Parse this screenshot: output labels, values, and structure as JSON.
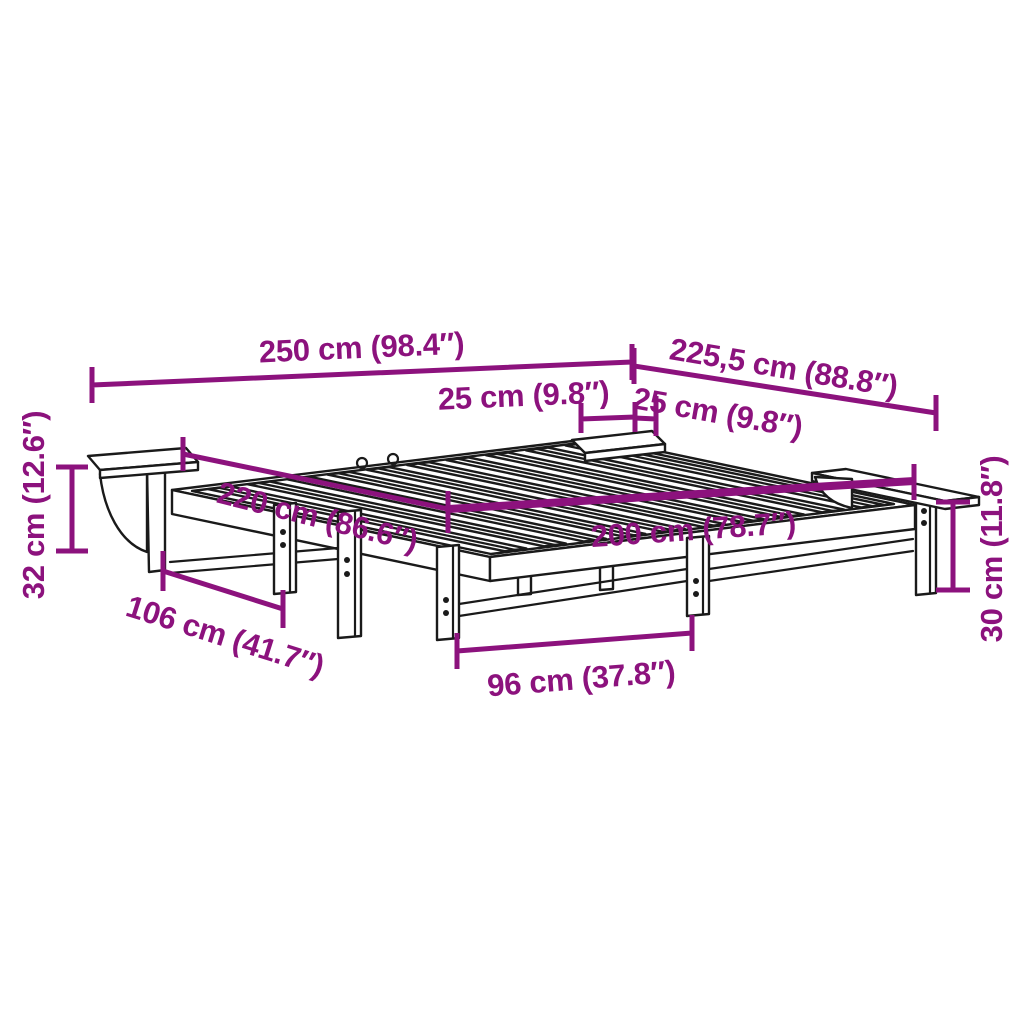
{
  "diagram": {
    "subject": "slatted bed frame with two side shelves, isometric line drawing with measurements",
    "unit_system": "centimeters with inches in parentheses"
  },
  "colors": {
    "accent": "#8C127D",
    "line": "#1a1a1a",
    "background": "#ffffff"
  },
  "dims": {
    "d250": {
      "label": "250 cm (98.4″)"
    },
    "d2255": {
      "label": "225,5 cm (88.8″)"
    },
    "d25a": {
      "label": "25 cm (9.8″)"
    },
    "d25b": {
      "label": "25 cm (9.8″)"
    },
    "d220": {
      "label": "220 cm (86.6″)"
    },
    "d200": {
      "label": "200 cm (78.7″)"
    },
    "d96": {
      "label": "96 cm (37.8″)"
    },
    "d106": {
      "label": "106 cm (41.7″)"
    },
    "d32": {
      "label": "32 cm (12.6″)"
    },
    "d30": {
      "label": "30 cm (11.8″)"
    }
  }
}
